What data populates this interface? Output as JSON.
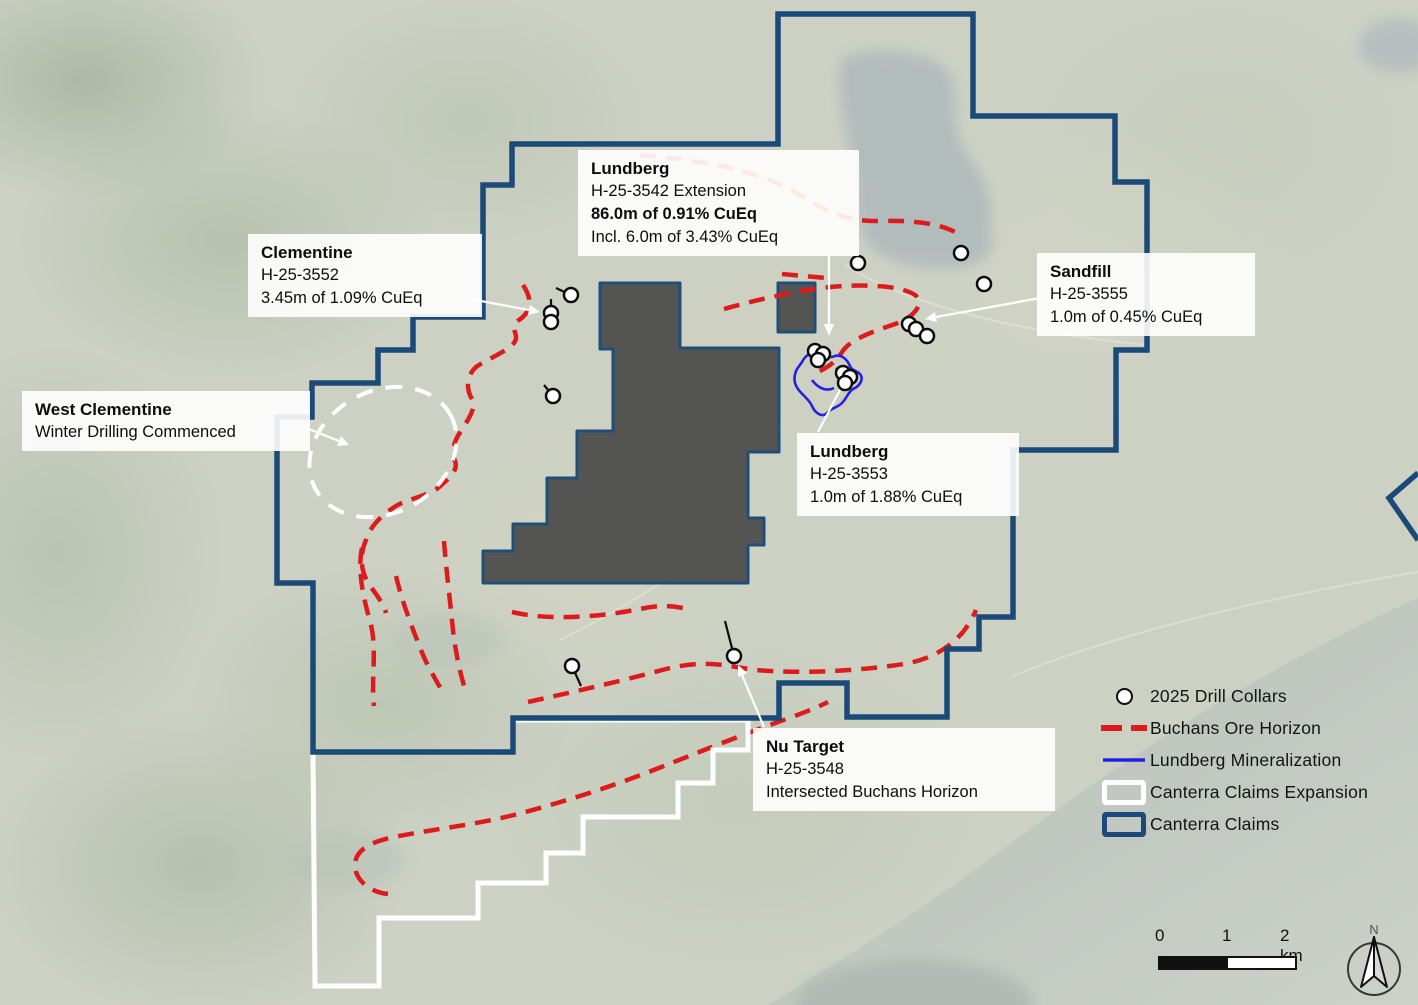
{
  "map": {
    "callouts": [
      {
        "id": "lundberg-main",
        "title": "Lundberg",
        "line1": "H-25-3542 Extension",
        "line2": "86.0m of 0.91% CuEq",
        "line3": "Incl. 6.0m of 3.43% CuEq"
      },
      {
        "id": "clementine",
        "title": "Clementine",
        "line1": "H-25-3552",
        "line2": "3.45m of 1.09% CuEq"
      },
      {
        "id": "west-clementine",
        "title": "West Clementine",
        "line1": "Winter Drilling Commenced"
      },
      {
        "id": "sandfill",
        "title": "Sandfill",
        "line1": "H-25-3555",
        "line2": "1.0m of 0.45% CuEq"
      },
      {
        "id": "lundberg-3553",
        "title": "Lundberg",
        "line1": "H-25-3553",
        "line2": "1.0m of 1.88% CuEq"
      },
      {
        "id": "nu-target",
        "title": "Nu Target",
        "line1": "H-25-3548",
        "line2": "Intersected Buchans Horizon"
      }
    ],
    "legend": {
      "items": [
        {
          "label": "2025 Drill Collars",
          "swatch": "drill-collar"
        },
        {
          "label": "Buchans Ore Horizon",
          "swatch": "red-dashed-line"
        },
        {
          "label": "Lundberg Mineralization",
          "swatch": "blue-line"
        },
        {
          "label": "Canterra Claims Expansion",
          "swatch": "white-outline-box"
        },
        {
          "label": "Canterra Claims",
          "swatch": "navy-outline-box"
        }
      ]
    },
    "scalebar": {
      "tick0": "0",
      "tick1": "1",
      "tick2": "2 km"
    },
    "north_label": "N",
    "colors": {
      "canterra_claims": "#1b4a78",
      "claims_expansion": "#ffffff",
      "buchans_ore_horizon": "#dc1c1c",
      "lundberg_mineralization": "#2121e6",
      "mine_area_fill": "#4a4a4a"
    }
  }
}
